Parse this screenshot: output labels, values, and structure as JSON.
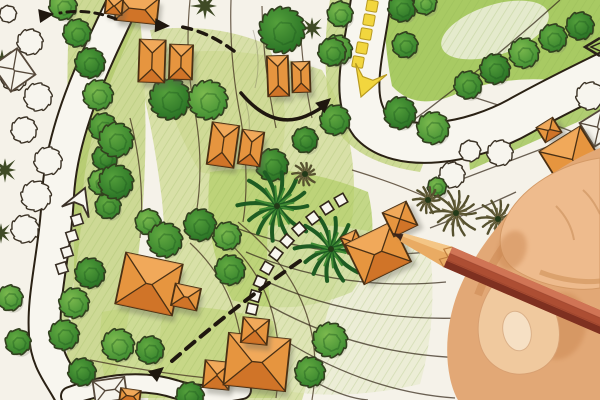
{
  "scene": {
    "alt_text": "Photograph of a hand-drawn landscape architecture site plan in colored pencil: orange hip-roof houses, green scalloped trees, curving white roads with yellow and white directional arrows, dashed pedestrian paths, palm symbols, lot boundary lines, and a hand holding a red pencil pointing at a house in the lower right.",
    "palette": {
      "paper": "#f5f2e9",
      "road_fill": "#f8f6ef",
      "road_border": "#2a2114",
      "lawn_main": "#cfdb96",
      "lawn_bright": "#a3c75c",
      "tree_green_dark": "#2c7a28",
      "tree_green_light": "#7cba4e",
      "tree_outline": "#32401f",
      "house_orange": "#e6953f",
      "house_orange_dark": "#cd7026",
      "house_orange_light": "#f2ad5f",
      "house_stroke": "#4a3014",
      "yellow_arrow": "#f2d63e",
      "yellow_arrow_edge": "#b89a20",
      "annotation_black": "#1f170f",
      "lot_line": "#4a3a25",
      "skin_light": "#f0c99e",
      "skin_mid": "#e2a876",
      "skin_shadow": "#c9854f",
      "pencil_red": "#ad4e33",
      "pencil_red_light": "#d07455",
      "pencil_red_dark": "#7e3020",
      "pencil_wood": "#e9ab63",
      "pencil_tip": "#3a241a"
    },
    "lawns": [
      {
        "d": "M 70,0 L 138,0 Q 152,120 140,240 Q 130,330 108,400 L 58,400 Q 80,300 72,200 Q 64,100 70,0 Z",
        "fill": "#c9d68c",
        "op": 0.9
      },
      {
        "d": "M 135,60 Q 230,38 322,70 Q 362,140 352,220 Q 332,300 302,400 L 148,400 Q 172,300 162,200 Q 152,120 135,60 Z",
        "fill": "#d2dd9b",
        "op": 0.85
      },
      {
        "d": "M 150,30 Q 215,22 268,45 Q 292,100 282,152 Q 240,182 200,172 Q 168,120 150,30 Z",
        "fill": "#cdd892",
        "op": 0.75
      },
      {
        "d": "M 330,0 L 354,0 Q 346,60 352,110 Q 365,138 392,142 Q 420,150 428,152 L 420,172 Q 352,162 332,122 Q 320,60 330,0 Z",
        "fill": "#c3d380",
        "op": 0.8
      },
      {
        "d": "M 385,0 L 600,0 L 600,88 Q 520,68 456,94 Q 416,112 392,86 Q 383,40 385,0 Z",
        "fill": "#a3c75c",
        "op": 0.95
      },
      {
        "d": "M 466,128 L 600,70 L 600,112 L 470,170 Z",
        "fill": "#a9c964",
        "op": 0.9
      },
      {
        "d": "M 210,172 Q 290,160 368,192 Q 382,250 352,292 Q 292,318 232,300 Q 202,240 210,172 Z",
        "fill": "#b6cf6e",
        "op": 0.8
      },
      {
        "d": "M 102,312 Q 190,296 276,322 Q 286,362 276,398 L 110,398 Q 96,355 102,312 Z",
        "fill": "#c3d47f",
        "op": 0.8
      },
      {
        "d": "M 268,226 Q 352,218 430,250 Q 438,320 420,384 Q 352,400 292,392 Q 262,310 268,226 Z",
        "fill": "#e3e7c4",
        "op": 0.5
      }
    ],
    "lawn_streaks": [
      {
        "d": "M 142,-5 C 112,60 78,130 76,200 C 74,262 60,300 62,340",
        "w": 13,
        "color": "#aac45f",
        "op": 0.6
      },
      {
        "d": "M 385,135 Q 450,158 520,128",
        "w": 10,
        "color": "#b9d070",
        "op": 0.5
      }
    ],
    "white_wedges": [
      {
        "cx": 495,
        "cy": 30,
        "rx": 56,
        "ry": 25,
        "rot": -18,
        "fill": "#eef0de",
        "op": 0.85
      }
    ],
    "roads": [
      {
        "d": "M 128,-8 C 98,55 62,125 58,195 C 55,255 42,295 45,335 C 47,368 66,380 76,408",
        "w": 30
      },
      {
        "d": "M 372,-8 C 366,45 348,95 370,124 C 398,155 470,145 522,115 C 558,95 590,80 614,68",
        "w": 38
      },
      {
        "d": "M 70,396 Q 130,374 178,390 Q 205,398 242,390",
        "w": 16
      }
    ],
    "lot_lines": [
      "M 190,0 Q 184,60 196,118 Q 204,168 196,215",
      "M 231,0 Q 229,60 241,120 Q 250,178 243,222",
      "M 262,6 Q 263,66 276,128",
      "M 300,20 Q 302,70 312,118",
      "M 130,118 Q 146,180 140,238",
      "M 214,230 Q 292,288 276,398",
      "M 190,243 Q 252,300 242,400",
      "M 238,222 Q 330,296 312,400",
      "M 90,360 Q 150,372 207,378",
      "M 352,170 Q 398,184 428,198"
    ],
    "contour_lines": [
      "M 236,228 Q 330,262 428,252",
      "M 246,252 Q 340,292 446,282",
      "M 257,277 Q 350,322 462,318",
      "M 270,306 Q 360,356 470,358",
      "M 284,340 Q 368,392 455,398",
      "M 300,373 Q 340,398 368,400",
      "M 428,192 L 552,145",
      "M 430,228 Q 478,210 516,192",
      "M 400,130 Q 480,72 560,0",
      "M 470,96 Q 540,118 598,142"
    ],
    "sketch_lines": [
      "M 253,30 Q 262,60 255,88",
      "M 244,96 Q 252,120 248,138"
    ],
    "trees": [
      {
        "x": 63,
        "y": 6,
        "r": 13
      },
      {
        "x": 77,
        "y": 33,
        "r": 13
      },
      {
        "x": 90,
        "y": 63,
        "r": 14
      },
      {
        "x": 98,
        "y": 95,
        "r": 14
      },
      {
        "x": 103,
        "y": 127,
        "r": 13
      },
      {
        "x": 105,
        "y": 158,
        "r": 12
      },
      {
        "x": 101,
        "y": 182,
        "r": 12
      },
      {
        "x": 108,
        "y": 206,
        "r": 12
      },
      {
        "x": 90,
        "y": 273,
        "r": 14
      },
      {
        "x": 74,
        "y": 303,
        "r": 14
      },
      {
        "x": 64,
        "y": 335,
        "r": 14
      },
      {
        "x": 82,
        "y": 372,
        "r": 13
      },
      {
        "x": 10,
        "y": 298,
        "r": 12
      },
      {
        "x": 18,
        "y": 342,
        "r": 12
      },
      {
        "x": 170,
        "y": 99,
        "r": 19
      },
      {
        "x": 208,
        "y": 100,
        "r": 18
      },
      {
        "x": 116,
        "y": 140,
        "r": 16
      },
      {
        "x": 116,
        "y": 182,
        "r": 16
      },
      {
        "x": 148,
        "y": 222,
        "r": 12
      },
      {
        "x": 165,
        "y": 240,
        "r": 16
      },
      {
        "x": 200,
        "y": 225,
        "r": 15
      },
      {
        "x": 227,
        "y": 236,
        "r": 13
      },
      {
        "x": 230,
        "y": 270,
        "r": 14
      },
      {
        "x": 272,
        "y": 165,
        "r": 15
      },
      {
        "x": 118,
        "y": 345,
        "r": 15
      },
      {
        "x": 150,
        "y": 350,
        "r": 13
      },
      {
        "x": 190,
        "y": 396,
        "r": 13
      },
      {
        "x": 330,
        "y": 340,
        "r": 16
      },
      {
        "x": 310,
        "y": 372,
        "r": 14
      },
      {
        "x": 282,
        "y": 30,
        "r": 21
      },
      {
        "x": 337,
        "y": 50,
        "r": 14
      },
      {
        "x": 335,
        "y": 120,
        "r": 14
      },
      {
        "x": 305,
        "y": 140,
        "r": 12
      },
      {
        "x": 340,
        "y": 14,
        "r": 12
      },
      {
        "x": 332,
        "y": 52,
        "r": 13
      },
      {
        "x": 402,
        "y": 8,
        "r": 13
      },
      {
        "x": 425,
        "y": 3,
        "r": 11
      },
      {
        "x": 405,
        "y": 45,
        "r": 12
      },
      {
        "x": 400,
        "y": 113,
        "r": 15
      },
      {
        "x": 433,
        "y": 128,
        "r": 15
      },
      {
        "x": 468,
        "y": 85,
        "r": 13
      },
      {
        "x": 495,
        "y": 69,
        "r": 14
      },
      {
        "x": 524,
        "y": 53,
        "r": 14
      },
      {
        "x": 553,
        "y": 38,
        "r": 13
      },
      {
        "x": 580,
        "y": 26,
        "r": 13
      },
      {
        "x": 437,
        "y": 187,
        "r": 9
      }
    ],
    "outline_trees": [
      {
        "x": 8,
        "y": 14,
        "r": 8
      },
      {
        "x": 30,
        "y": 42,
        "r": 12
      },
      {
        "x": 14,
        "y": 78,
        "r": 12
      },
      {
        "x": 38,
        "y": 97,
        "r": 13
      },
      {
        "x": 24,
        "y": 130,
        "r": 12
      },
      {
        "x": 48,
        "y": 161,
        "r": 13
      },
      {
        "x": 36,
        "y": 196,
        "r": 14
      },
      {
        "x": 25,
        "y": 229,
        "r": 13
      },
      {
        "x": 452,
        "y": 175,
        "r": 12
      },
      {
        "x": 470,
        "y": 151,
        "r": 10
      },
      {
        "x": 500,
        "y": 153,
        "r": 12
      },
      {
        "x": 590,
        "y": 96,
        "r": 13
      }
    ],
    "conifers": [
      {
        "x": 2,
        "y": 60,
        "r": 12
      },
      {
        "x": 5,
        "y": 170,
        "r": 13
      },
      {
        "x": 1,
        "y": 233,
        "r": 11
      },
      {
        "x": 205,
        "y": 6,
        "r": 14
      },
      {
        "x": 312,
        "y": 28,
        "r": 12
      }
    ],
    "palms": [
      {
        "x": 277,
        "y": 206,
        "r": 37
      },
      {
        "x": 331,
        "y": 249,
        "r": 34
      }
    ],
    "palm_sketches": [
      {
        "x": 456,
        "y": 213,
        "r": 24
      },
      {
        "x": 498,
        "y": 219,
        "r": 20
      },
      {
        "x": 428,
        "y": 200,
        "r": 14
      },
      {
        "x": 305,
        "y": 174,
        "r": 12
      }
    ],
    "houses": [
      {
        "name": "house-top-a",
        "parts": [
          {
            "x": 137,
            "y": 9,
            "w": 42,
            "h": 26,
            "a": 6,
            "style": "filled"
          },
          {
            "x": 114,
            "y": 6,
            "w": 17,
            "h": 16,
            "a": 6,
            "style": "filled"
          }
        ]
      },
      {
        "name": "house-pair-b",
        "parts": [
          {
            "x": 152,
            "y": 61,
            "w": 26,
            "h": 42,
            "a": 2,
            "style": "filled"
          },
          {
            "x": 181,
            "y": 62,
            "w": 23,
            "h": 34,
            "a": 2,
            "style": "filled"
          }
        ]
      },
      {
        "name": "house-pair-d",
        "parts": [
          {
            "x": 223,
            "y": 145,
            "w": 27,
            "h": 42,
            "a": 8,
            "style": "filled"
          },
          {
            "x": 251,
            "y": 148,
            "w": 22,
            "h": 34,
            "a": 8,
            "style": "filled"
          }
        ]
      },
      {
        "name": "house-pair-e",
        "parts": [
          {
            "x": 278,
            "y": 76,
            "w": 21,
            "h": 40,
            "a": -2,
            "style": "filled"
          },
          {
            "x": 301,
            "y": 77,
            "w": 18,
            "h": 30,
            "a": -2,
            "style": "filled"
          }
        ]
      },
      {
        "name": "house-f-right",
        "parts": [
          {
            "x": 598,
            "y": 128,
            "w": 26,
            "h": 28,
            "a": -32,
            "style": "outline"
          },
          {
            "x": 549,
            "y": 130,
            "w": 19,
            "h": 17,
            "a": -32,
            "style": "filled"
          },
          {
            "x": 574,
            "y": 162,
            "w": 48,
            "h": 54,
            "a": -32,
            "style": "filled"
          }
        ]
      },
      {
        "name": "house-g-pointed-at",
        "parts": [
          {
            "x": 352,
            "y": 242,
            "w": 17,
            "h": 18,
            "a": -26,
            "style": "filled"
          },
          {
            "x": 378,
            "y": 253,
            "w": 52,
            "h": 44,
            "a": -26,
            "style": "filled"
          },
          {
            "x": 400,
            "y": 219,
            "w": 26,
            "h": 26,
            "a": -26,
            "style": "filled"
          }
        ]
      },
      {
        "name": "house-h-left",
        "parts": [
          {
            "x": 149,
            "y": 284,
            "w": 58,
            "h": 52,
            "a": 12,
            "style": "filled"
          },
          {
            "x": 186,
            "y": 297,
            "w": 26,
            "h": 22,
            "a": 12,
            "style": "filled"
          }
        ]
      },
      {
        "name": "house-i-bottom",
        "parts": [
          {
            "x": 217,
            "y": 375,
            "w": 26,
            "h": 27,
            "a": 6,
            "style": "filled"
          },
          {
            "x": 257,
            "y": 362,
            "w": 62,
            "h": 52,
            "a": 6,
            "style": "filled"
          },
          {
            "x": 255,
            "y": 331,
            "w": 26,
            "h": 25,
            "a": 6,
            "style": "filled"
          }
        ]
      },
      {
        "name": "sketch-house-corner",
        "parts": [
          {
            "x": 14,
            "y": 70,
            "w": 30,
            "h": 32,
            "a": -35,
            "style": "outline"
          }
        ]
      },
      {
        "name": "sketch-house-bottom",
        "parts": [
          {
            "x": 110,
            "y": 390,
            "w": 32,
            "h": 22,
            "a": -8,
            "style": "outline"
          },
          {
            "x": 130,
            "y": 396,
            "w": 20,
            "h": 13,
            "a": 8,
            "style": "filled"
          }
        ]
      }
    ],
    "white_square_path": {
      "points": [
        [
          341,
          200
        ],
        [
          327,
          208
        ],
        [
          313,
          218
        ],
        [
          299,
          229
        ],
        [
          287,
          241
        ],
        [
          276,
          254
        ],
        [
          267,
          268
        ],
        [
          260,
          282
        ],
        [
          255,
          296
        ],
        [
          252,
          309
        ]
      ],
      "size": 10
    },
    "yellow_arrow": {
      "squares": [
        [
          372,
          6
        ],
        [
          369,
          20
        ],
        [
          366,
          34
        ],
        [
          362,
          48
        ],
        [
          358,
          62
        ]
      ],
      "size": 11,
      "rot": 10,
      "head": {
        "x": 361,
        "y": 97,
        "angle": 110,
        "len": 30,
        "wid": 32
      }
    },
    "white_arrow": {
      "squares": [
        [
          62,
          268
        ],
        [
          67,
          252
        ],
        [
          72,
          236
        ],
        [
          77,
          220
        ]
      ],
      "size": 10,
      "rot": -18,
      "head": {
        "x": 85,
        "y": 188,
        "angle": -68,
        "len": 26,
        "wid": 28
      }
    },
    "dashed_arrows": [
      {
        "d": "M 234,51 Q 206,30 176,26",
        "w": 3.5,
        "dash": "9 7",
        "head": {
          "x": 170,
          "y": 26,
          "angle": 183
        }
      },
      {
        "d": "M 300,261 Q 240,302 172,361",
        "w": 4,
        "dash": "11 8",
        "head": {
          "x": 164,
          "y": 367,
          "angle": 140
        }
      },
      {
        "d": "M 116,19 Q 88,8 60,13",
        "w": 3,
        "dash": "8 6",
        "head": {
          "x": 54,
          "y": 14,
          "angle": 172
        }
      }
    ],
    "solid_arrows": [
      {
        "d": "M 241,93 Q 272,130 306,116 Q 320,110 327,103",
        "w": 3.5,
        "head": {
          "x": 331,
          "y": 98,
          "angle": -42
        }
      }
    ],
    "outline_chevrons": [
      {
        "d": "M 474,357 L 489,374 L 503,358",
        "w": 2.5
      },
      {
        "d": "M 481,359 L 489,368 L 497,358",
        "w": 1.5
      },
      {
        "d": "M 600,38 L 585,47 L 600,56",
        "w": 2.5
      },
      {
        "d": "M 600,43 L 591,47 L 600,51",
        "w": 1.5
      }
    ],
    "hand": {
      "palm": "M 600,148 C 565,162 532,186 508,214 C 488,237 470,262 458,292 C 448,318 444,350 450,378 C 453,392 458,400 458,400 L 600,400 Z",
      "palm_shade": "M 600,170 C 570,180 545,198 525,220 C 505,242 488,268 478,295",
      "web_shadow": {
        "cx": 560,
        "cy": 326,
        "rx": 26,
        "ry": 34,
        "rot": 15
      },
      "index_finger": "M 600,158 C 560,164 524,186 507,216 C 495,238 499,260 517,271 C 544,287 578,292 600,288 Z",
      "finger_shade": "M 540,272 C 560,280 585,283 600,281",
      "fingertip_shadow": {
        "cx": 512,
        "cy": 250,
        "rx": 14,
        "ry": 20,
        "rot": 20
      },
      "thumb": "M 500,276 C 483,295 474,320 480,344 C 486,366 508,378 530,373 C 551,368 562,350 559,327 C 556,305 543,288 524,280 C 515,276 506,274 500,276 Z",
      "nail": {
        "cx": 517,
        "cy": 331,
        "rx": 14,
        "ry": 20,
        "rot": -12
      },
      "creases": [
        "M 556,206 C 566,216 572,228 574,240",
        "M 583,190 C 592,198 597,208 600,214"
      ]
    },
    "pencil": {
      "tip_x": 392,
      "tip_y": 233,
      "angle": 23.2,
      "tip_len": 13,
      "cone_len": 48,
      "body_len": 200,
      "half_w": 11
    }
  }
}
